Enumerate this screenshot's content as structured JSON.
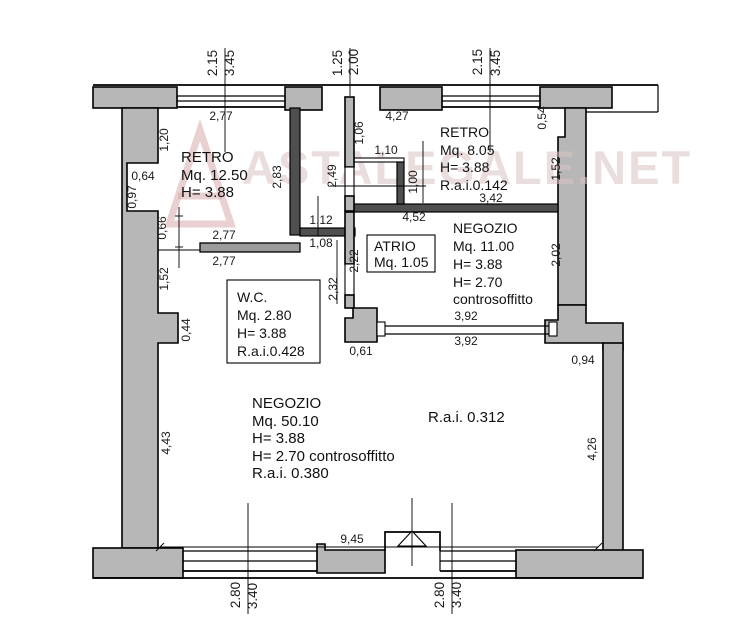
{
  "watermark": {
    "text": "ASTALEGALE.NET"
  },
  "rooms": {
    "retro_left": {
      "name": "RETRO",
      "line2": "Mq. 12.50",
      "line3": "H= 3.88"
    },
    "retro_right": {
      "name": "RETRO",
      "line2": "Mq. 8.05",
      "line3": "H= 3.88",
      "line4": "R.a.i.0.142"
    },
    "atrio": {
      "name": "ATRIO",
      "line2": "Mq. 1.05"
    },
    "negozio_small": {
      "name": "NEGOZIO",
      "line2": "Mq. 11.00",
      "line3": "H= 3.88",
      "line4": "H= 2.70",
      "line5": "controsoffitto"
    },
    "wc": {
      "name": "W.C.",
      "line2": "Mq. 2.80",
      "line3": "H= 3.88",
      "line4": "R.a.i.0.428"
    },
    "negozio_large": {
      "name": "NEGOZIO",
      "line2": "Mq. 50.10",
      "line3": "H= 3.88",
      "line4": "H= 2.70  controsoffitto",
      "line5": "R.a.i. 0.380"
    },
    "rai_note": "R.a.i. 0.312"
  },
  "dims": {
    "top_left_a": "2.15",
    "top_left_b": "3.45",
    "top_mid_a": "1.25",
    "top_mid_b": "2.00",
    "top_right_a": "2.15",
    "top_right_b": "3.45",
    "win_top_left": "2,77",
    "win_top_right": "4,27",
    "v120": "1,20",
    "v106": "1,06",
    "h110": "1,10",
    "v283": "2,83",
    "v249": "2,49",
    "v100": "1,00",
    "h064": "0,64",
    "v097": "0,97",
    "v054": "0,54",
    "v152r": "1,52",
    "h342": "3,42",
    "h452": "4,52",
    "v066": "0,66",
    "h277a": "2,77",
    "h277b": "2,77",
    "h112": "1,12",
    "h108": "1,08",
    "v222": "2,22",
    "v202": "2,02",
    "v232": "2,32",
    "v152l": "1,52",
    "v044": "0,44",
    "h061": "0,61",
    "h392a": "3,92",
    "h392b": "3,92",
    "h094": "0,94",
    "v443": "4,43",
    "v426": "4,26",
    "h945": "9,45",
    "bot_left_a": "2.80",
    "bot_left_b": "3.40",
    "bot_right_a": "2.80",
    "bot_right_b": "3.40"
  }
}
